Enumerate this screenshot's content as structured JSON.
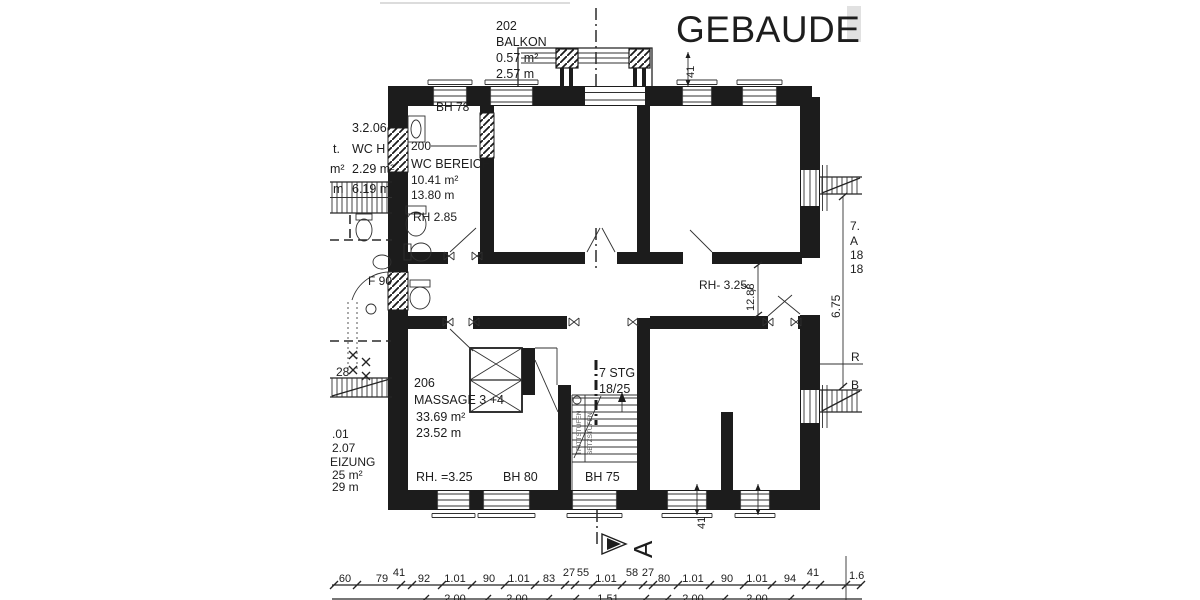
{
  "title": "GEBAUDE",
  "balcony": {
    "number": "202",
    "name": "BALKON",
    "area": "0.57 m²",
    "length": "2.57 m",
    "dim": "41"
  },
  "wc": {
    "bh": "BH 78",
    "number": "200",
    "name": "WC BEREICH",
    "area": "10.41 m²",
    "length": "13.80 m",
    "rh": "RH 2.85"
  },
  "massage": {
    "number": "206",
    "name": "MASSAGE 3 +4",
    "area": "33.69 m²",
    "length": "23.52 m",
    "rh": "RH. =3.25",
    "bh": "BH 80"
  },
  "stairs": {
    "count": "7 STG",
    "ratio": "18/25",
    "bh": "BH 75",
    "side1": "TRITTSTUFEN",
    "side2": "SETZSTUFEN"
  },
  "corridor": {
    "rh": "RH- 3.25",
    "dim": "12.88"
  },
  "section": {
    "letter": "A"
  },
  "left_neighbor": {
    "a1": "3.2.06",
    "a2": "WC H",
    "a3": "2.29 m²",
    "a4": "6.19 m",
    "f2": "t.",
    "f3": "m²",
    "f4": "m",
    "f90": "F 90",
    "n28": "28",
    "b1": ".01",
    "b2": "2.07",
    "b3": "EIZUNG",
    "b4": "25 m²",
    "b5": "29 m"
  },
  "right_neighbor": {
    "dim": "6.75",
    "l1": "7.",
    "l2": "A",
    "l3": "18",
    "l4": "18",
    "r": "R",
    "b": "B"
  },
  "dims": {
    "row1": [
      "60",
      "79",
      "41",
      "92",
      "1.01",
      "90",
      "1.01",
      "83",
      "27",
      "55",
      "1.01",
      "58",
      "27",
      "80",
      "1.01",
      "90",
      "1.01",
      "94",
      "41"
    ],
    "tail": "1.6",
    "row2": [
      "2.00",
      "2.00",
      "1.51",
      "2.00",
      "2.00"
    ],
    "wall41": "41"
  }
}
